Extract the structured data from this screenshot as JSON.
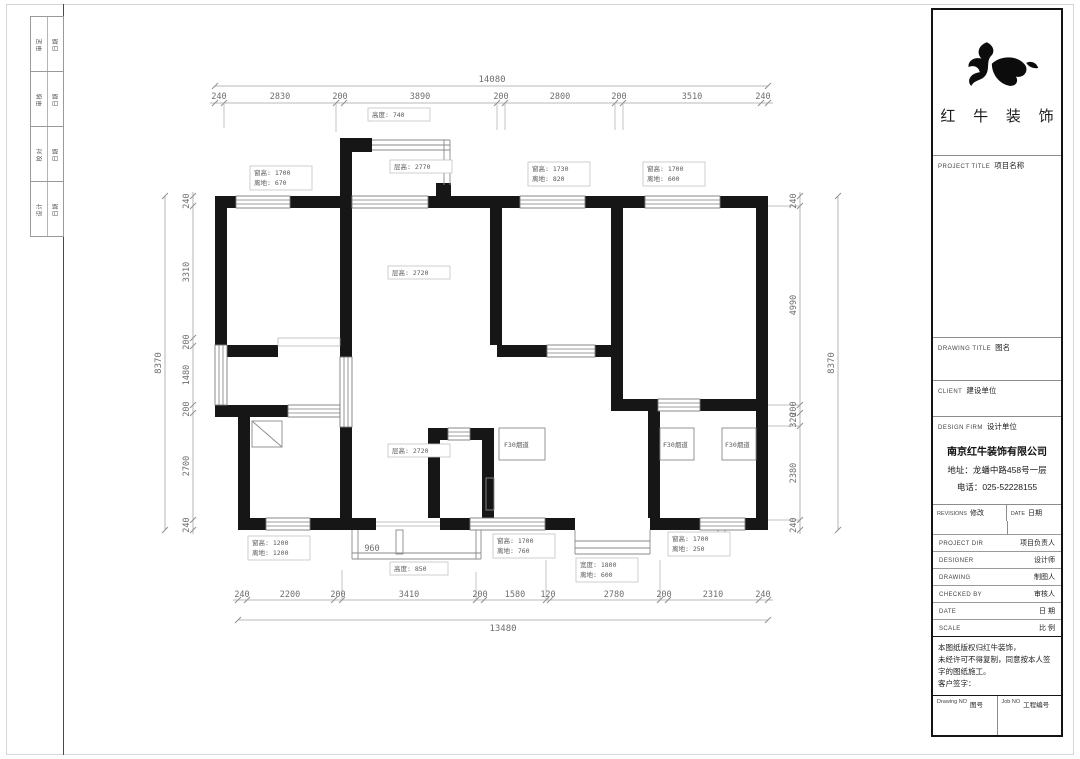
{
  "binding_strip": {
    "rows": [
      {
        "left": "审定",
        "right": "日期"
      },
      {
        "left": "审核",
        "right": "日期"
      },
      {
        "left": "校对",
        "right": "日期"
      },
      {
        "left": "设计",
        "right": "日期"
      }
    ]
  },
  "plan": {
    "dims": {
      "top_total": "14080",
      "top": [
        "240",
        "2830",
        "200",
        "3890",
        "200",
        "2800",
        "200",
        "3510",
        "240"
      ],
      "bottom": [
        "240",
        "2200",
        "200",
        "3410",
        "200",
        "1580",
        "120",
        "2780",
        "200",
        "2310",
        "240"
      ],
      "bottom_total": "13480",
      "left": [
        "240",
        "3310",
        "200",
        "1480",
        "200",
        "2700",
        "240"
      ],
      "left_total": "8370",
      "right": [
        "240",
        "4990",
        "200",
        "320",
        "2380",
        "240"
      ],
      "right_total": "8370",
      "terrace_width": "960"
    },
    "labels": {
      "bay_height": "高度: 740",
      "bay_level": "层高: 2770",
      "win_tl_1": "窗高: 1700",
      "win_tl_2": "离地: 670",
      "win_tm_1": "窗高: 1730",
      "win_tm_2": "离地: 820",
      "win_tr_1": "窗高: 1700",
      "win_tr_2": "离地: 600",
      "living_level": "层高: 2720",
      "dining_level": "层高: 2720",
      "flue": "F30烟道",
      "win_bl_1": "窗高: 1200",
      "win_bl_2": "离地: 1200",
      "win_bm_1": "窗高: 1700",
      "win_bm_2": "离地: 760",
      "win_br_1": "窗高: 1700",
      "win_br_2": "离地: 250",
      "bay_b_1": "宽度: 1800",
      "bay_b_2": "离地: 600",
      "terrace_height": "高度: 850"
    }
  },
  "titleblock": {
    "brand": "红 牛 装 饰",
    "project_title_en": "PROJECT TITLE",
    "project_title_zh": "项目名称",
    "drawing_title_en": "DRAWING TITLE",
    "drawing_title_zh": "图名",
    "client_en": "CLIENT",
    "client_zh": "建设单位",
    "design_firm_en": "DESIGN FIRM",
    "design_firm_zh": "设计单位",
    "company_name": "南京红牛装饰有限公司",
    "company_address": "地址：龙蟠中路458号一层",
    "company_phone": "电话：025-52228155",
    "revisions_en": "REVISIONS",
    "revisions_zh": "修改",
    "date_en": "DATE",
    "date_zh": "日期",
    "rows": [
      {
        "en": "PROJECT DIR",
        "zh": "项目负责人"
      },
      {
        "en": "DESIGNER",
        "zh": "设计师"
      },
      {
        "en": "DRAWING",
        "zh": "制图人"
      },
      {
        "en": "CHECKED BY",
        "zh": "审核人"
      },
      {
        "en": "DATE",
        "zh": "日 期"
      },
      {
        "en": "SCALE",
        "zh": "比 例"
      }
    ],
    "note_line1": "本图纸版权归红牛装饰，",
    "note_line2": "未经许可不得复制，同意按本人签字的图纸施工。",
    "note_line3": "客户签字：",
    "drawing_no_en": "Drawing NO",
    "drawing_no_zh": "图号",
    "job_no_en": "Job NO",
    "job_no_zh": "工程编号"
  }
}
